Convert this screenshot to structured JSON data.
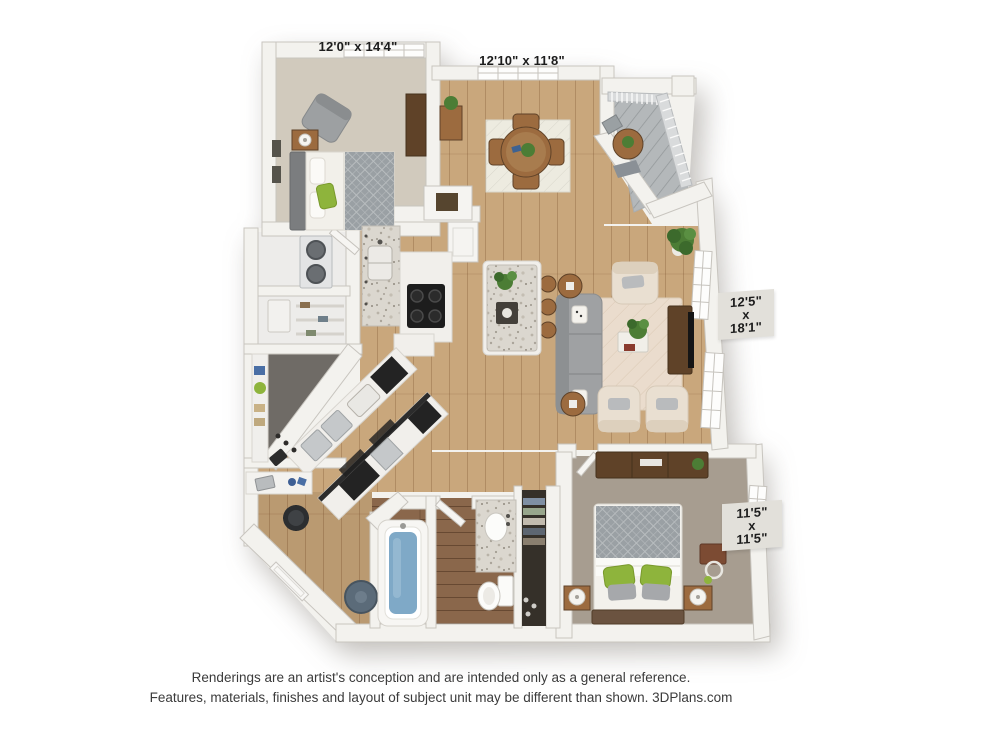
{
  "page": {
    "background": "#ffffff"
  },
  "labels": {
    "bedroom1": "12'0\" x 14'4\"",
    "dining": "12'10\" x 11'8\"",
    "living": {
      "l1": "12'5\"",
      "l2": "x",
      "l3": "18'1\""
    },
    "bedroom2": {
      "l1": "11'5\"",
      "l2": "x",
      "l3": "11'5\""
    }
  },
  "disclaimer": {
    "line1": "Renderings are an artist's conception and are intended only as a general reference.",
    "line2": "Features, materials, finishes and layout of subject unit may be different than shown. 3DPlans.com"
  },
  "colors": {
    "wall": "#f3f2ee",
    "wallEdge": "#c8c5bf",
    "wood": "#c9a77c",
    "bathwood": "#8a674b",
    "carpet1": "#d1cabd",
    "carpet2": "#a79d90",
    "closetFloor": "#6f6b66",
    "deck": "#b4b8ba",
    "rugLiving": "#eadccd",
    "rugDining": "#edebe0",
    "sofa": "#9fa1a3",
    "cream": "#e9dfd1",
    "woodMid": "#9c6b3f",
    "woodDark": "#5f4228",
    "green": "#8eb43c",
    "plant": "#4c7d35",
    "water": "#7fa9c7",
    "steel": "#c5c8ca",
    "labelBg": "#e2e0da",
    "ink": "#1c1c1c",
    "muted": "#3b3b3b"
  }
}
